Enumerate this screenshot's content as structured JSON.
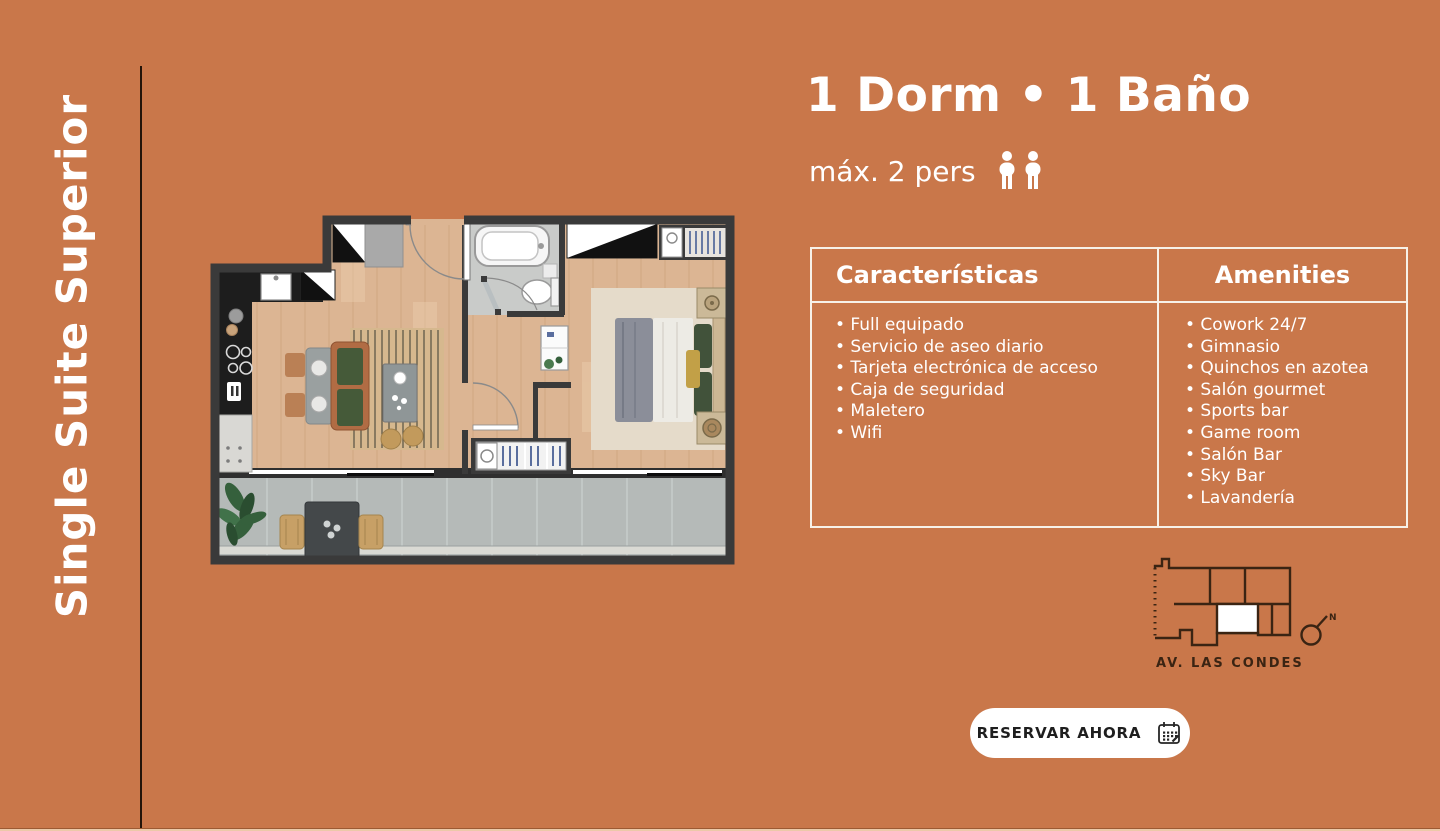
{
  "theme": {
    "background": "#c9774a",
    "text_light": "#ffffff",
    "divider_dark": "#241409",
    "table_border": "#f7f1e8",
    "map_ink": "#3a2413",
    "button_bg": "#ffffff",
    "button_text": "#1e1e1e"
  },
  "sidebar": {
    "title": "Single Suite Superior"
  },
  "header": {
    "title": "1 Dorm • 1 Baño",
    "capacity_label": "máx. 2 pers",
    "capacity_icon": "two-persons-icon"
  },
  "info_table": {
    "bullet": "•",
    "columns": [
      {
        "header": "Características",
        "items": [
          "Full equipado",
          "Servicio de aseo diario",
          "Tarjeta electrónica de acceso",
          "Caja de seguridad",
          "Maletero",
          "Wifi"
        ]
      },
      {
        "header": "Amenities",
        "items": [
          "Cowork 24/7",
          "Gimnasio",
          "Quinchos en azotea",
          "Salón gourmet",
          "Sports bar",
          "Game room",
          "Salón Bar",
          "Sky Bar",
          "Lavandería"
        ]
      }
    ]
  },
  "location_map": {
    "street_label": "AV. LAS CONDES",
    "north_label": "N"
  },
  "cta": {
    "label": "RESERVAR AHORA",
    "icon": "calendar-icon"
  }
}
